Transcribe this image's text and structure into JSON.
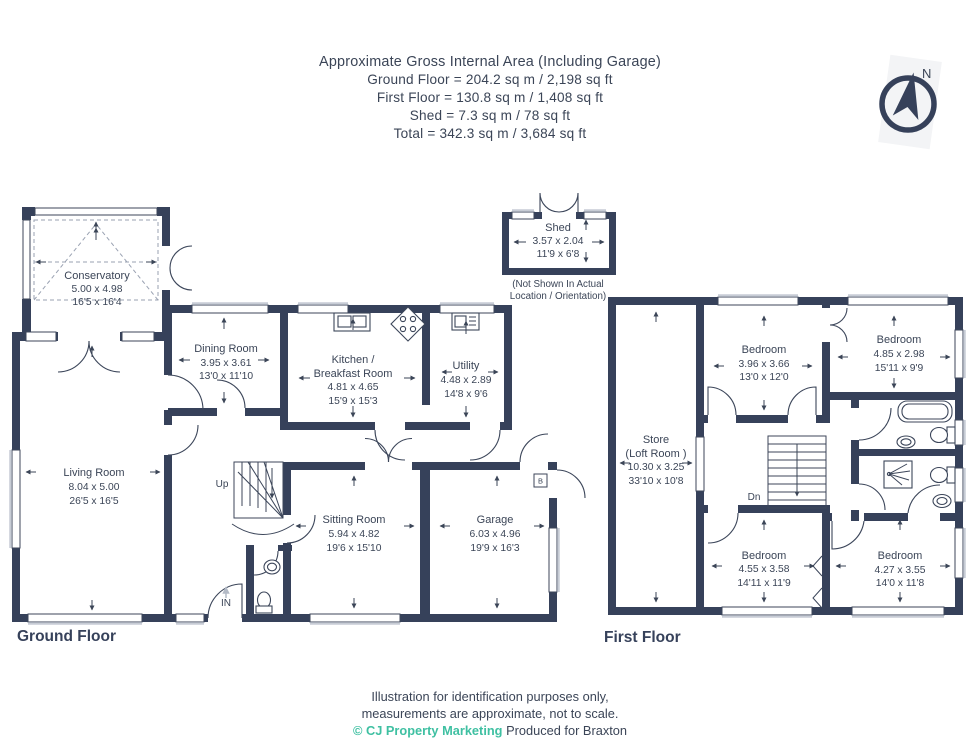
{
  "header": {
    "line1": "Approximate Gross Internal Area (Including Garage)",
    "line2": "Ground Floor = 204.2 sq m / 2,198 sq ft",
    "line3": "First Floor = 130.8 sq m / 1,408 sq ft",
    "line4": "Shed = 7.3 sq m / 78 sq ft",
    "line5": "Total = 342.3 sq m / 3,684 sq ft"
  },
  "compass": {
    "north_label": "N"
  },
  "shed": {
    "name": "Shed",
    "metric": "3.57 x 2.04",
    "imperial": "11'9 x 6'8",
    "note_line1": "(Not Shown In Actual",
    "note_line2": "Location / Orientation)"
  },
  "ground_floor": {
    "label": "Ground Floor",
    "annotations": {
      "up": "Up",
      "entrance": "IN",
      "boiler": "B"
    },
    "rooms": {
      "conservatory": {
        "name": "Conservatory",
        "metric": "5.00 x 4.98",
        "imperial": "16'5 x 16'4"
      },
      "living_room": {
        "name": "Living Room",
        "metric": "8.04 x 5.00",
        "imperial": "26'5 x 16'5"
      },
      "dining_room": {
        "name": "Dining Room",
        "metric": "3.95 x 3.61",
        "imperial": "13'0 x 11'10"
      },
      "kitchen": {
        "name_line1": "Kitchen /",
        "name_line2": "Breakfast Room",
        "metric": "4.81 x 4.65",
        "imperial": "15'9 x 15'3"
      },
      "utility": {
        "name": "Utility",
        "metric": "4.48 x 2.89",
        "imperial": "14'8 x 9'6"
      },
      "sitting_room": {
        "name": "Sitting Room",
        "metric": "5.94 x 4.82",
        "imperial": "19'6 x 15'10"
      },
      "garage": {
        "name": "Garage",
        "metric": "6.03 x 4.96",
        "imperial": "19'9 x 16'3"
      }
    }
  },
  "first_floor": {
    "label": "First Floor",
    "annotations": {
      "down": "Dn"
    },
    "rooms": {
      "store": {
        "name_line1": "Store",
        "name_line2": "(Loft Room )",
        "metric": "10.30 x 3.25",
        "imperial": "33'10 x 10'8"
      },
      "bedroom_top_left": {
        "name": "Bedroom",
        "metric": "3.96 x 3.66",
        "imperial": "13'0 x 12'0"
      },
      "bedroom_top_right": {
        "name": "Bedroom",
        "metric": "4.85 x 2.98",
        "imperial": "15'11 x 9'9"
      },
      "bedroom_bottom_left": {
        "name": "Bedroom",
        "metric": "4.55 x 3.58",
        "imperial": "14'11 x 11'9"
      },
      "bedroom_bottom_right": {
        "name": "Bedroom",
        "metric": "4.27 x 3.55",
        "imperial": "14'0 x 11'8"
      }
    }
  },
  "footer": {
    "line1": "Illustration for identification purposes only,",
    "line2": "measurements are approximate, not to scale.",
    "copyright": "© CJ Property Marketing",
    "produced": "Produced for Braxton"
  },
  "colors": {
    "wall": "#36415a",
    "text": "#3b4557",
    "teal": "#3fc0a2"
  }
}
